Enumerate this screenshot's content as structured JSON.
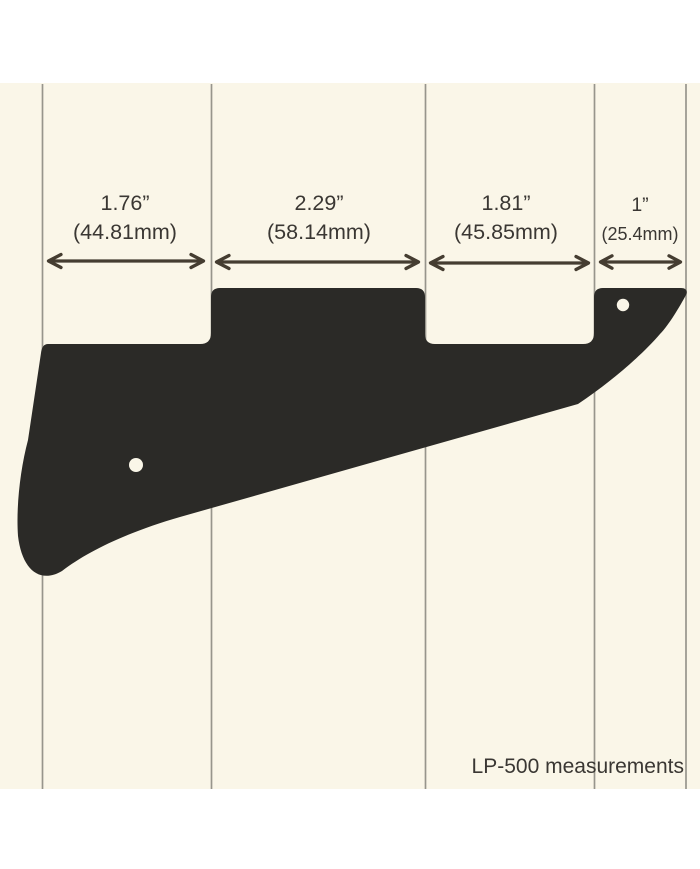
{
  "footer": {
    "label": "LP-500 measurements"
  },
  "measurements": [
    {
      "inches": "1.76”",
      "mm": "(44.81mm)"
    },
    {
      "inches": "2.29”",
      "mm": "(58.14mm)"
    },
    {
      "inches": "1.81”",
      "mm": "(45.85mm)"
    },
    {
      "inches": "1”",
      "mm": "(25.4mm)"
    }
  ],
  "colors": {
    "background": "#ffffff",
    "panel": "#faf6e8",
    "ruled_line": "#97958c",
    "pickguard": "#2b2a27",
    "text": "#3a3733",
    "arrow": "#453d31"
  }
}
